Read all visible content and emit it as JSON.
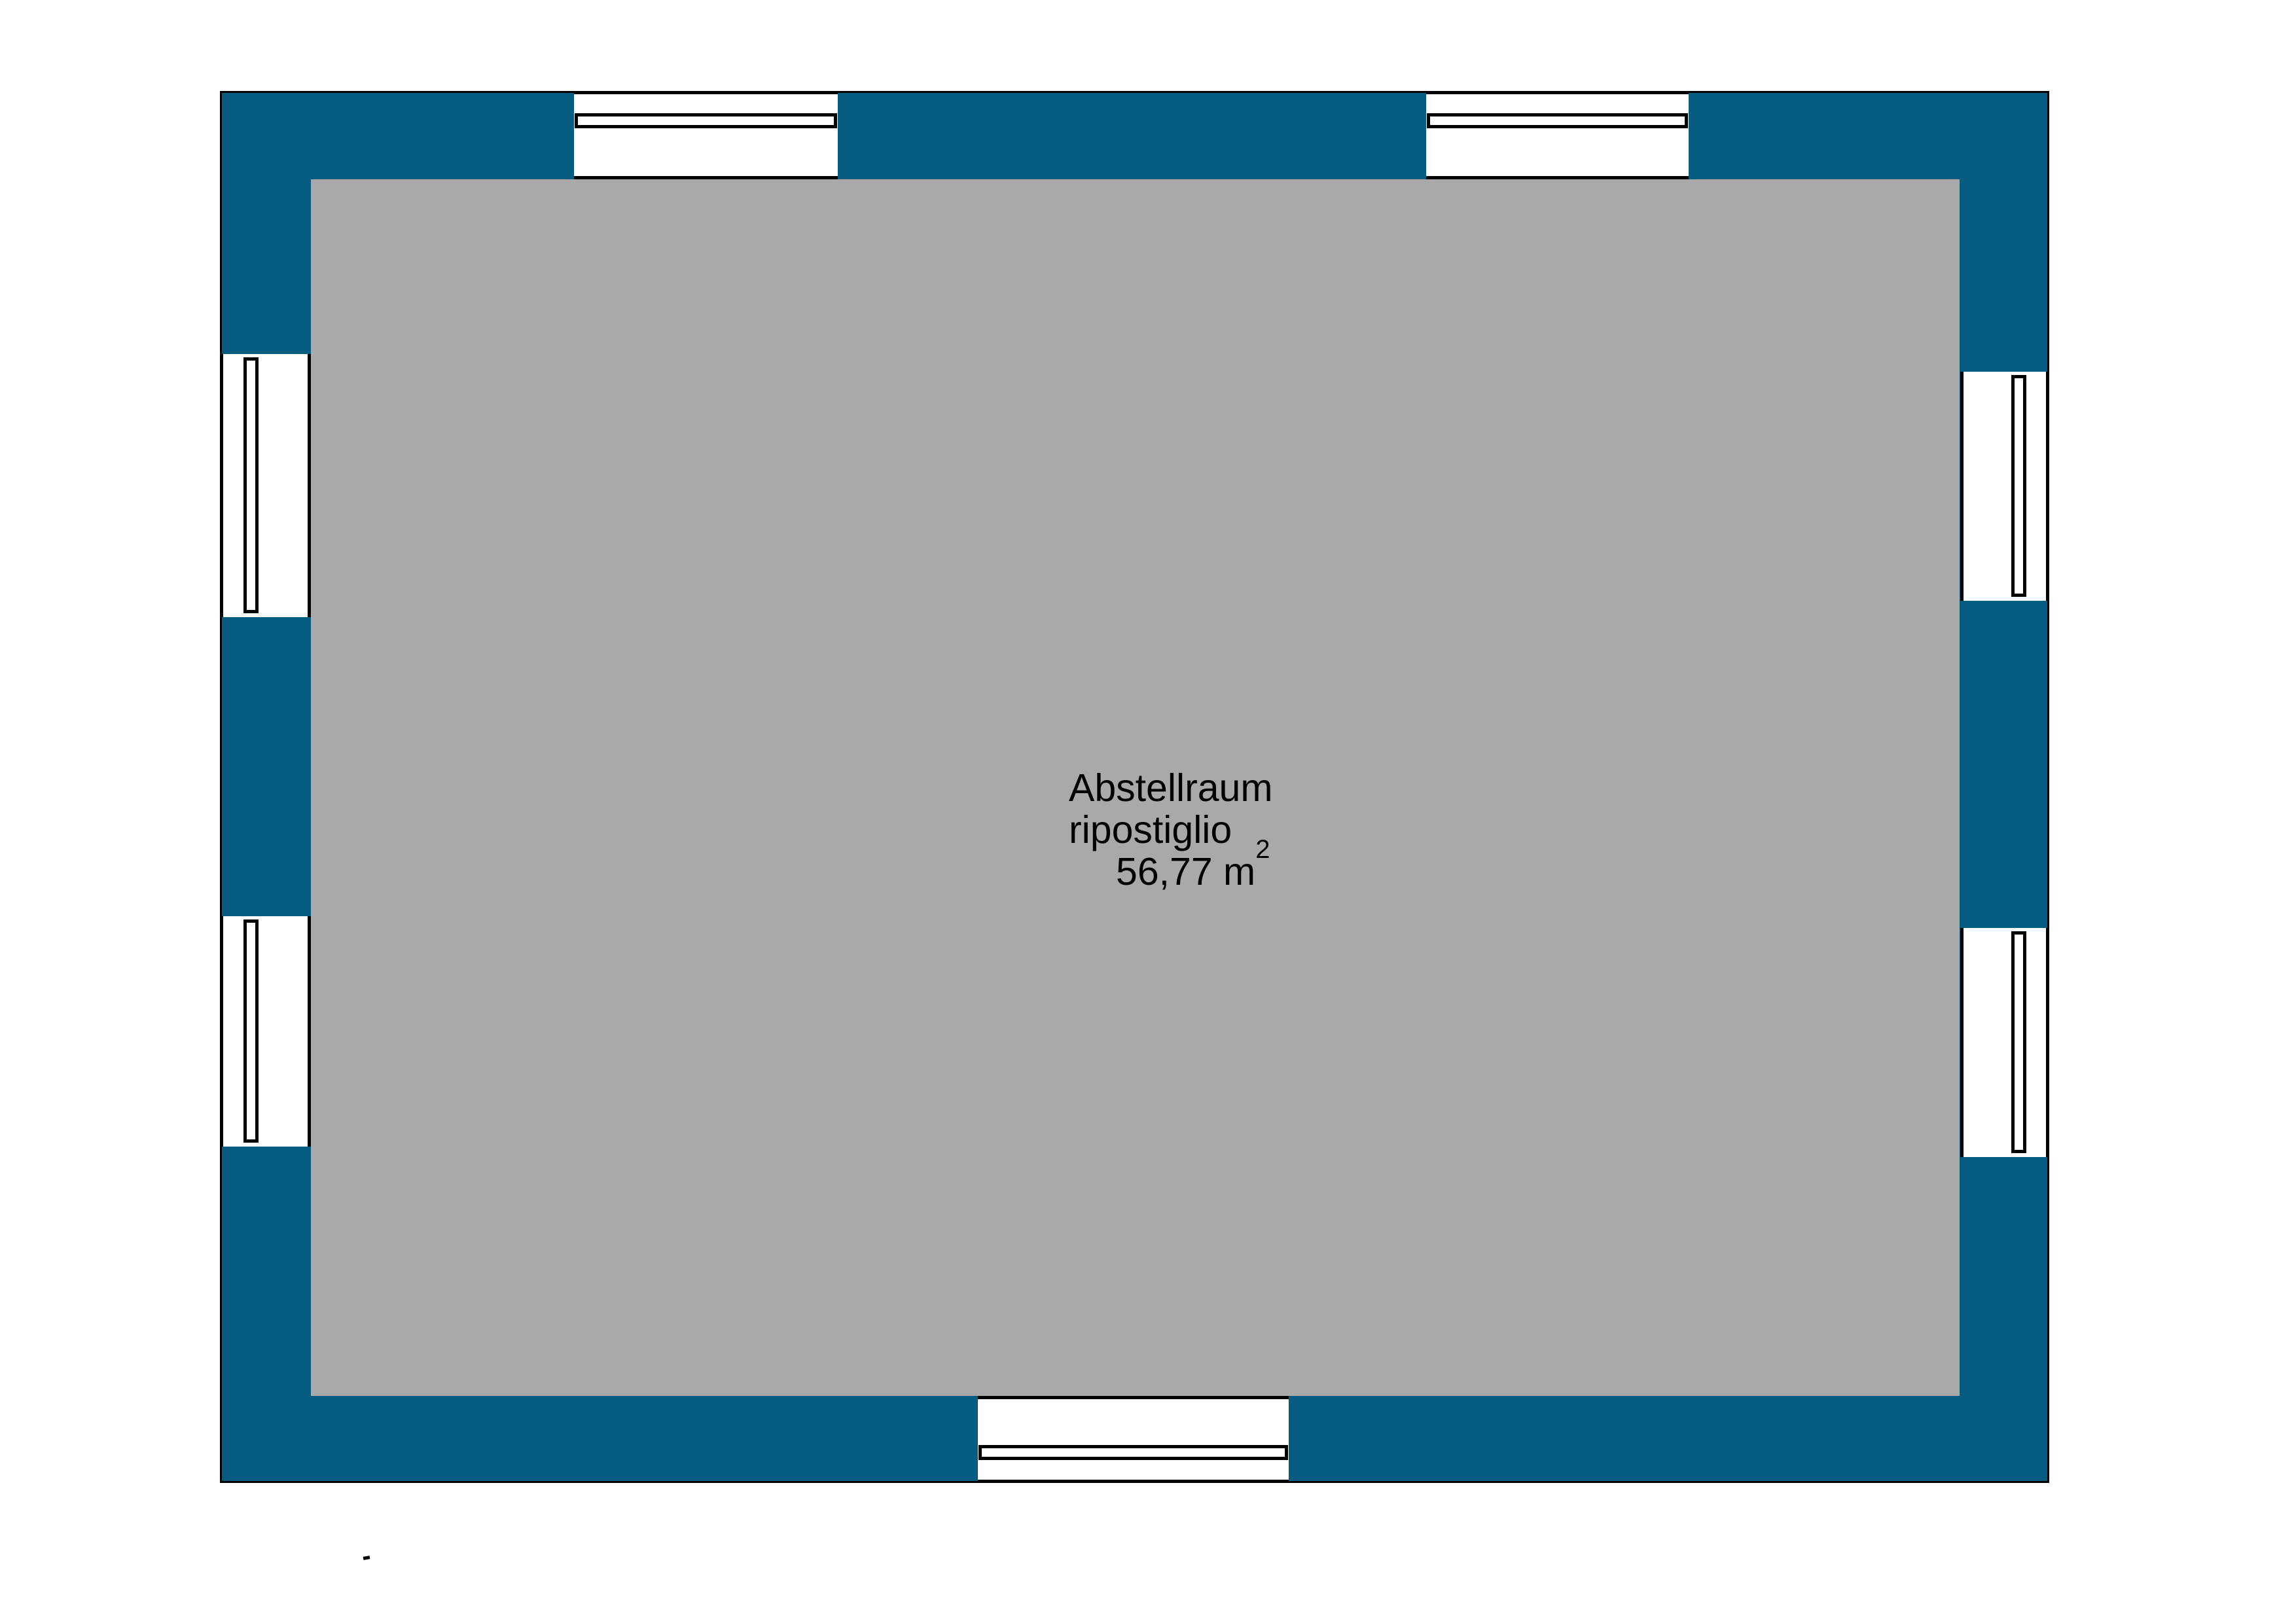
{
  "plan": {
    "type": "floor-plan",
    "room": {
      "label_line1": "Abstellraum",
      "label_line2": "ripostiglio",
      "area_value": "56,77 m",
      "area_superscript": "2"
    },
    "windows": [
      {
        "id": "window-top-1",
        "wall": "top"
      },
      {
        "id": "window-top-2",
        "wall": "top"
      },
      {
        "id": "window-left-1",
        "wall": "left"
      },
      {
        "id": "window-left-2",
        "wall": "left"
      },
      {
        "id": "window-right-1",
        "wall": "right"
      },
      {
        "id": "window-right-2",
        "wall": "right"
      },
      {
        "id": "window-bottom-1",
        "wall": "bottom"
      }
    ],
    "colors": {
      "wall": "#055B80",
      "floor": "#A9A9A9",
      "line": "#000000",
      "background": "#FFFFFF"
    }
  }
}
